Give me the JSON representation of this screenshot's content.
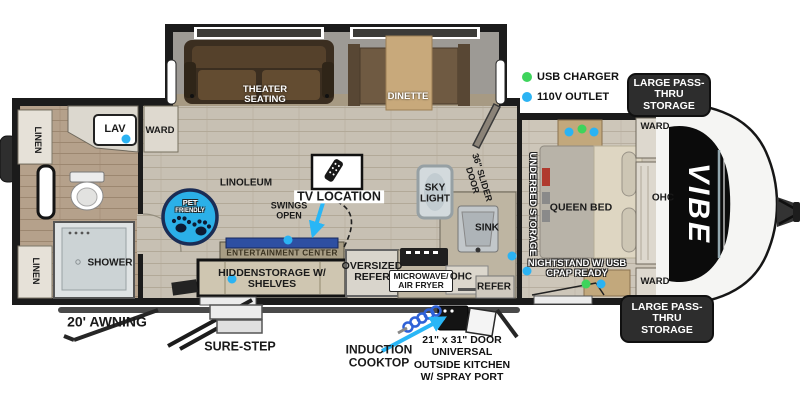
{
  "brand": "VIBE",
  "colors": {
    "usb_marker": "#3ed45c",
    "outlet_marker": "#2bb3f3",
    "pet_badge": "#2bb0e8",
    "counter_accent": "#2e4fa2"
  },
  "legend": {
    "usb": "USB CHARGER",
    "outlet": "110V OUTLET"
  },
  "exterior": {
    "pass_thru_top": "LARGE PASS-THRU STORAGE",
    "pass_thru_bottom": "LARGE PASS-THRU STORAGE",
    "awning": "20' AWNING",
    "sure_step": "SURE-STEP",
    "induction_cooktop": "INDUCTION COOKTOP",
    "outside_kitchen_lines": [
      "21\" x 31\" DOOR",
      "UNIVERSAL",
      "OUTSIDE KITCHEN",
      "W/ SPRAY PORT"
    ]
  },
  "bathroom": {
    "linen_top": "LINEN",
    "linen_bottom": "LINEN",
    "lav": "LAV",
    "shower": "SHOWER"
  },
  "living": {
    "ward": "WARD",
    "theater_seating": "THEATER SEATING",
    "dinette": "DINETTE",
    "linoleum": "LINOLEUM",
    "pet_line1": "PET",
    "pet_line2": "FRIENDLY",
    "tv_location": "TV LOCATION",
    "swings_open": "SWINGS OPEN",
    "entertainment_center": "ENTERTAINMENT CENTER",
    "hidden_storage": "HIDDENSTORAGE W/ SHELVES"
  },
  "kitchen": {
    "oversized_refer": "OVERSIZED REFER",
    "microwave": "MICROWAVE/ AIR FRYER",
    "ohc": "OHC",
    "refer": "REFER",
    "sink": "SINK",
    "sky_light": "SKY LIGHT",
    "slider_door": "36\" SLIDER DOOR"
  },
  "bedroom": {
    "underbed": "UNDERBED STORAGE",
    "queen_bed": "QUEEN BED",
    "nightstand": "NIGHTSTAND W/ USB CPAP READY",
    "ward_top": "WARD",
    "ward_bottom": "WARD",
    "ohc": "OHC"
  }
}
